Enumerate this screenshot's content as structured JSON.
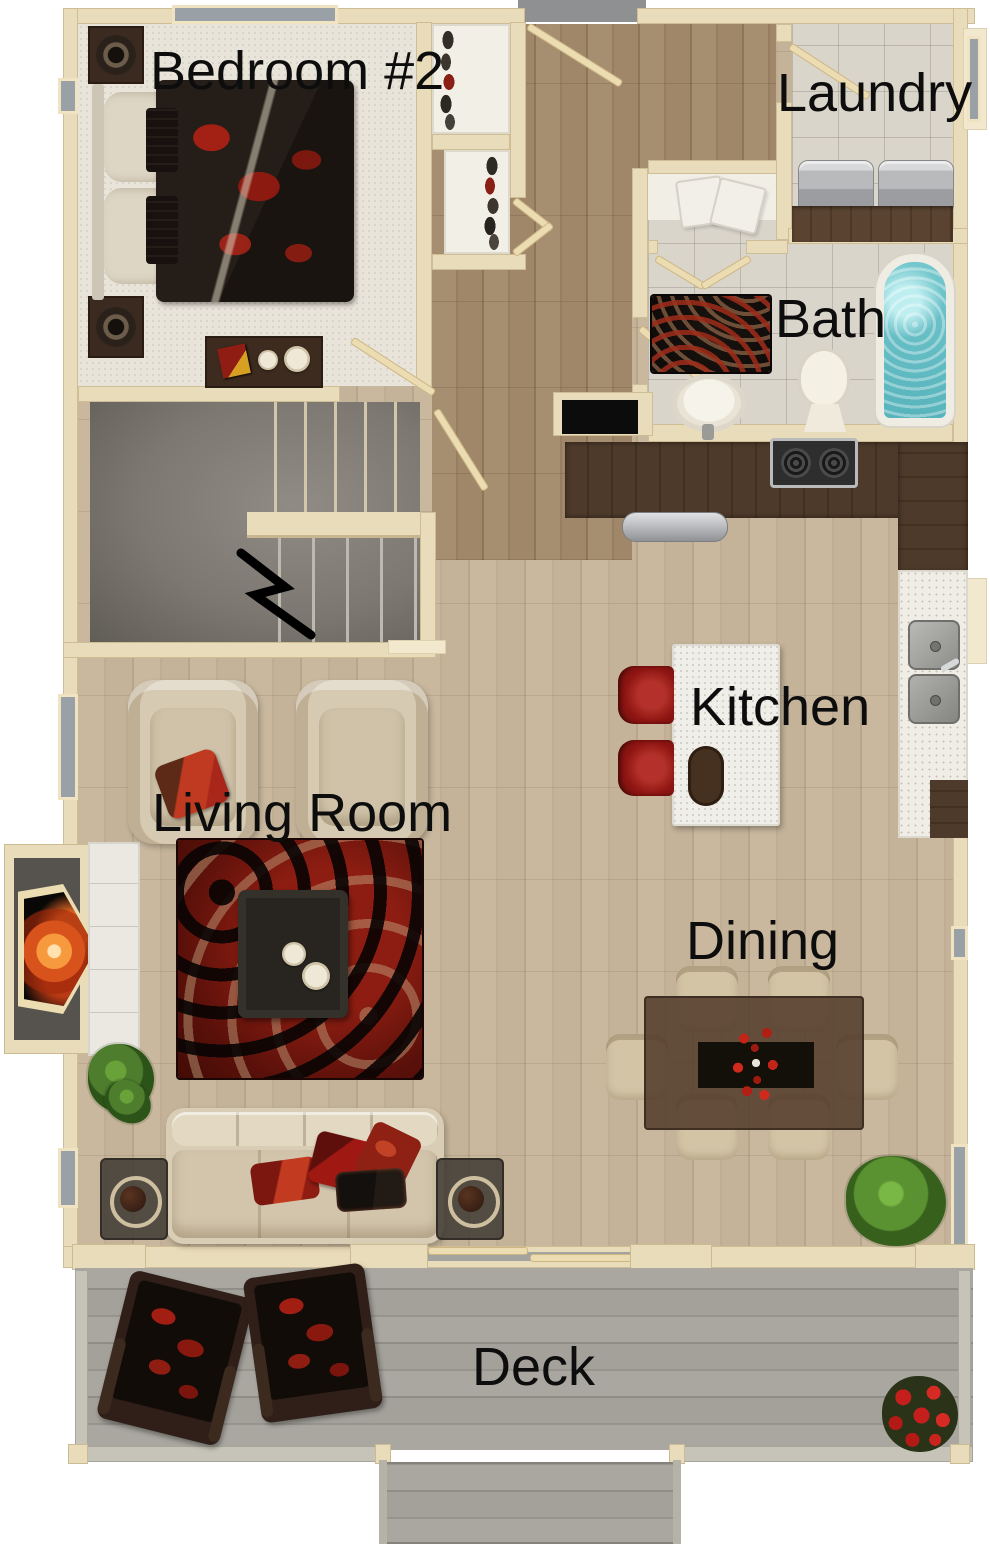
{
  "page": {
    "type": "3D top-down floor plan rendering",
    "background": "#ffffff"
  },
  "rooms": {
    "bedroom2": {
      "label": "Bedroom #2"
    },
    "laundry": {
      "label": "Laundry"
    },
    "bath": {
      "label": "Bath"
    },
    "kitchen": {
      "label": "Kitchen"
    },
    "living": {
      "label": "Living Room"
    },
    "dining": {
      "label": "Dining"
    },
    "deck": {
      "label": "Deck"
    }
  },
  "palette": {
    "wall_cream": "#e9dcba",
    "wood_hall_dark": "#a68e70",
    "wood_main_light": "#c9b89e",
    "bedroom_carpet": "#e9e4da",
    "tile": "#dad5cb",
    "deck_gray": "#a9a7a0",
    "stair_gray": "#7c7871",
    "accent_red": "#9c1613",
    "rug_dark_red": "#6b1410",
    "fire_orange": "#f08a30",
    "tub_water_teal": "#74c7cd",
    "counter_dark_wood": "#4d3a2a",
    "counter_white": "#efede5",
    "label_text": "#0d0d0d"
  }
}
